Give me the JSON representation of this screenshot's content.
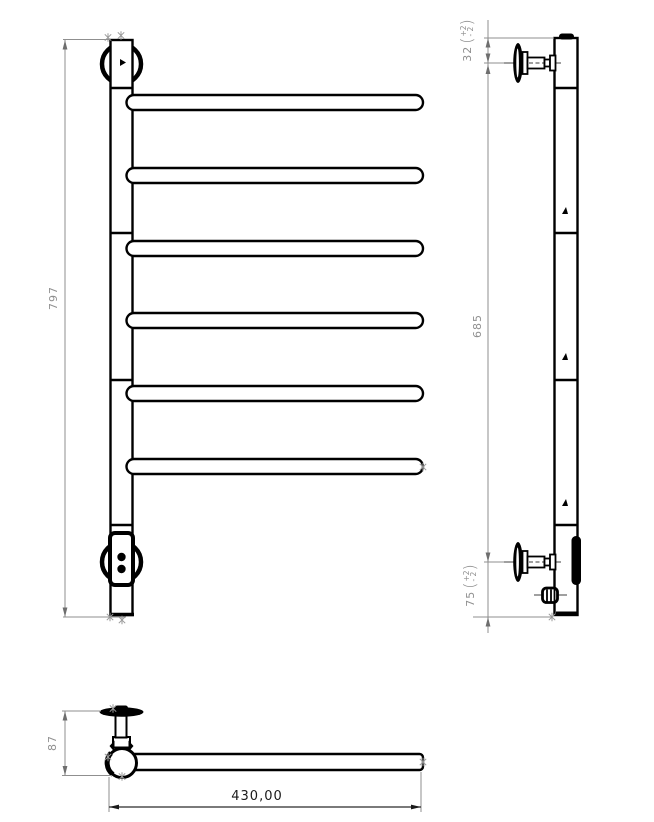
{
  "drawing_title": "towel-rail-technical-drawing",
  "colors": {
    "line": "#000000",
    "dimension": "#8f8f8f",
    "background": "#ffffff"
  },
  "views": {
    "front": {
      "name": "front view",
      "bar_count": 6
    },
    "side": {
      "name": "side view",
      "bracket_count": 2
    },
    "top": {
      "name": "top view"
    }
  },
  "dimensions": {
    "overall_height": {
      "value": "797"
    },
    "bracket_spacing": {
      "value": "685"
    },
    "top_bracket_offset": {
      "value": "32",
      "paren_open": "(",
      "tol_plus": "+2",
      "tol_minus": "- 2",
      "paren_close": ")"
    },
    "bottom_bracket_offset": {
      "value": "75",
      "paren_open": "(",
      "tol_plus": "+2",
      "tol_minus": "- 2",
      "paren_close": ")"
    },
    "depth": {
      "value": "87"
    },
    "rail_width": {
      "value": "430,00"
    }
  }
}
